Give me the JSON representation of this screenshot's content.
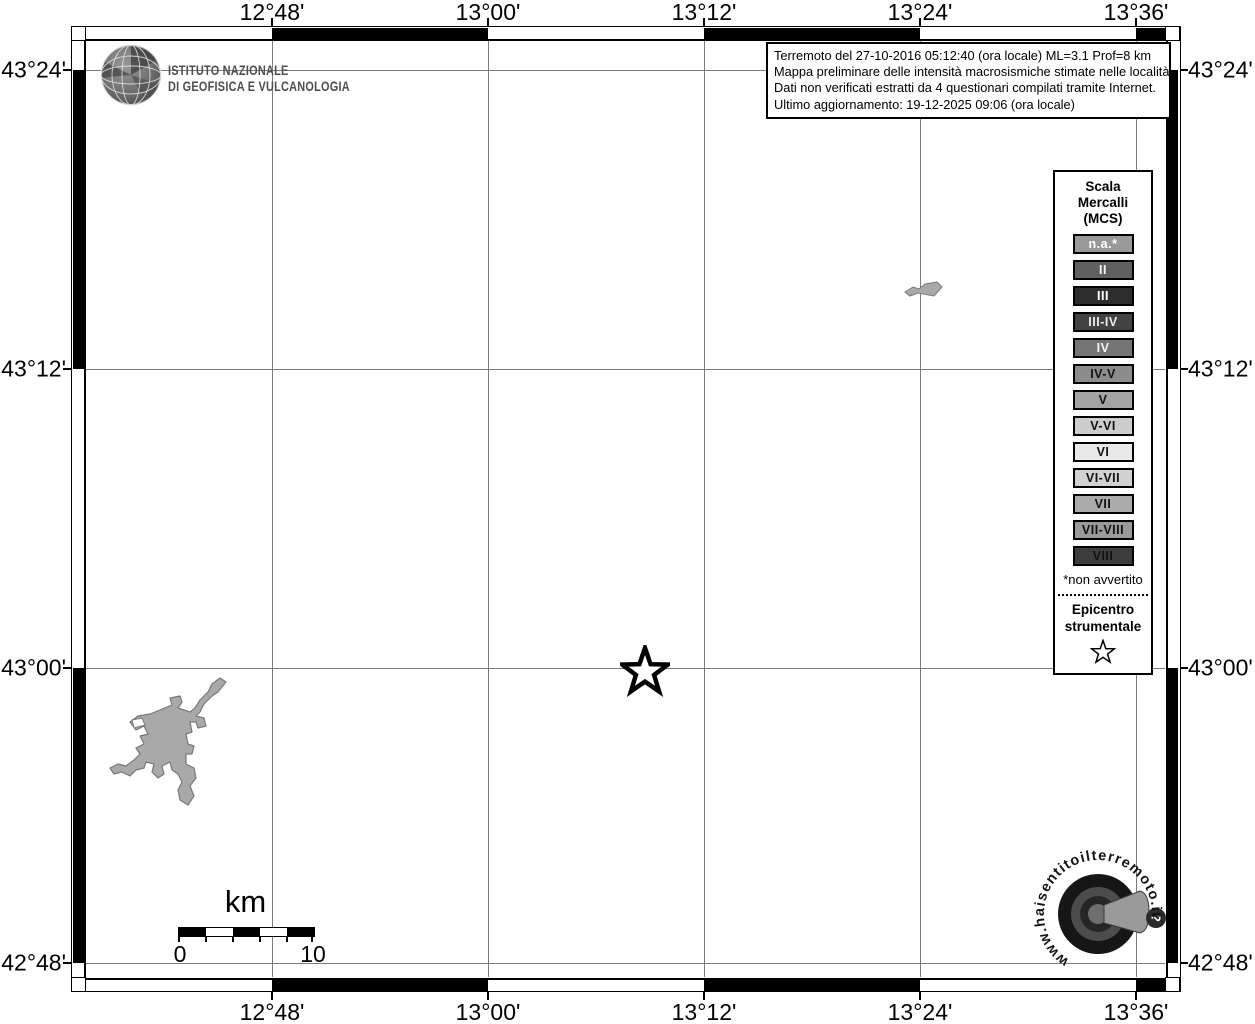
{
  "axes": {
    "top": [
      "12°48'",
      "13°00'",
      "13°12'",
      "13°24'",
      "13°36'"
    ],
    "bottom": [
      "12°48'",
      "13°00'",
      "13°12'",
      "13°24'",
      "13°36'"
    ],
    "left": [
      "43°24'",
      "43°12'",
      "43°00'",
      "42°48'"
    ],
    "right": [
      "43°24'",
      "43°12'",
      "43°00'",
      "42°48'"
    ]
  },
  "branding": {
    "institute_line1": "ISTITUTO NAZIONALE",
    "institute_line2": "DI GEOFISICA E VULCANOLOGIA"
  },
  "info_box": {
    "line1": "Terremoto del 27-10-2016 05:12:40 (ora locale) ML=3.1 Prof=8 km",
    "line2": "Mappa preliminare delle intensità macrosismiche stimate nelle località",
    "line3": "Dati non verificati estratti da 4 questionari compilati tramite Internet.",
    "line4": "Ultimo aggiornamento: 19-12-2025 09:06 (ora locale)"
  },
  "legend": {
    "title": "Scala Mercalli (MCS)",
    "items": [
      {
        "label": "n.a.*",
        "bg": "#9a9a9a",
        "fg": "#ffffff"
      },
      {
        "label": "II",
        "bg": "#606060",
        "fg": "#f2f2f2"
      },
      {
        "label": "III",
        "bg": "#2d2d2d",
        "fg": "#ffffff"
      },
      {
        "label": "III-IV",
        "bg": "#424242",
        "fg": "#ededed"
      },
      {
        "label": "IV",
        "bg": "#757575",
        "fg": "#f5f5f5"
      },
      {
        "label": "IV-V",
        "bg": "#8c8c8c",
        "fg": "#111111"
      },
      {
        "label": "V",
        "bg": "#a3a3a3",
        "fg": "#111111"
      },
      {
        "label": "V-VI",
        "bg": "#cdcdcd",
        "fg": "#111111"
      },
      {
        "label": "VI",
        "bg": "#e8e8e8",
        "fg": "#111111"
      },
      {
        "label": "VI-VII",
        "bg": "#d2d2d2",
        "fg": "#111111"
      },
      {
        "label": "VII",
        "bg": "#ababab",
        "fg": "#111111"
      },
      {
        "label": "VII-VIII",
        "bg": "#9a9a9a",
        "fg": "#111111"
      },
      {
        "label": "VIII",
        "bg": "#3d3d3d",
        "fg": "#111111"
      }
    ],
    "footnote": "*non avvertito",
    "epicenter_label": "Epicentro strumentale"
  },
  "scale_bar": {
    "unit_label": "km",
    "tick_start": "0",
    "tick_end": "10"
  },
  "watermark": {
    "url_text": "www.haisentitoilterremoto.it",
    "question_mark": "?"
  },
  "map": {
    "epicenter": {
      "lon": "13°08'",
      "lat": "43°00'"
    }
  }
}
